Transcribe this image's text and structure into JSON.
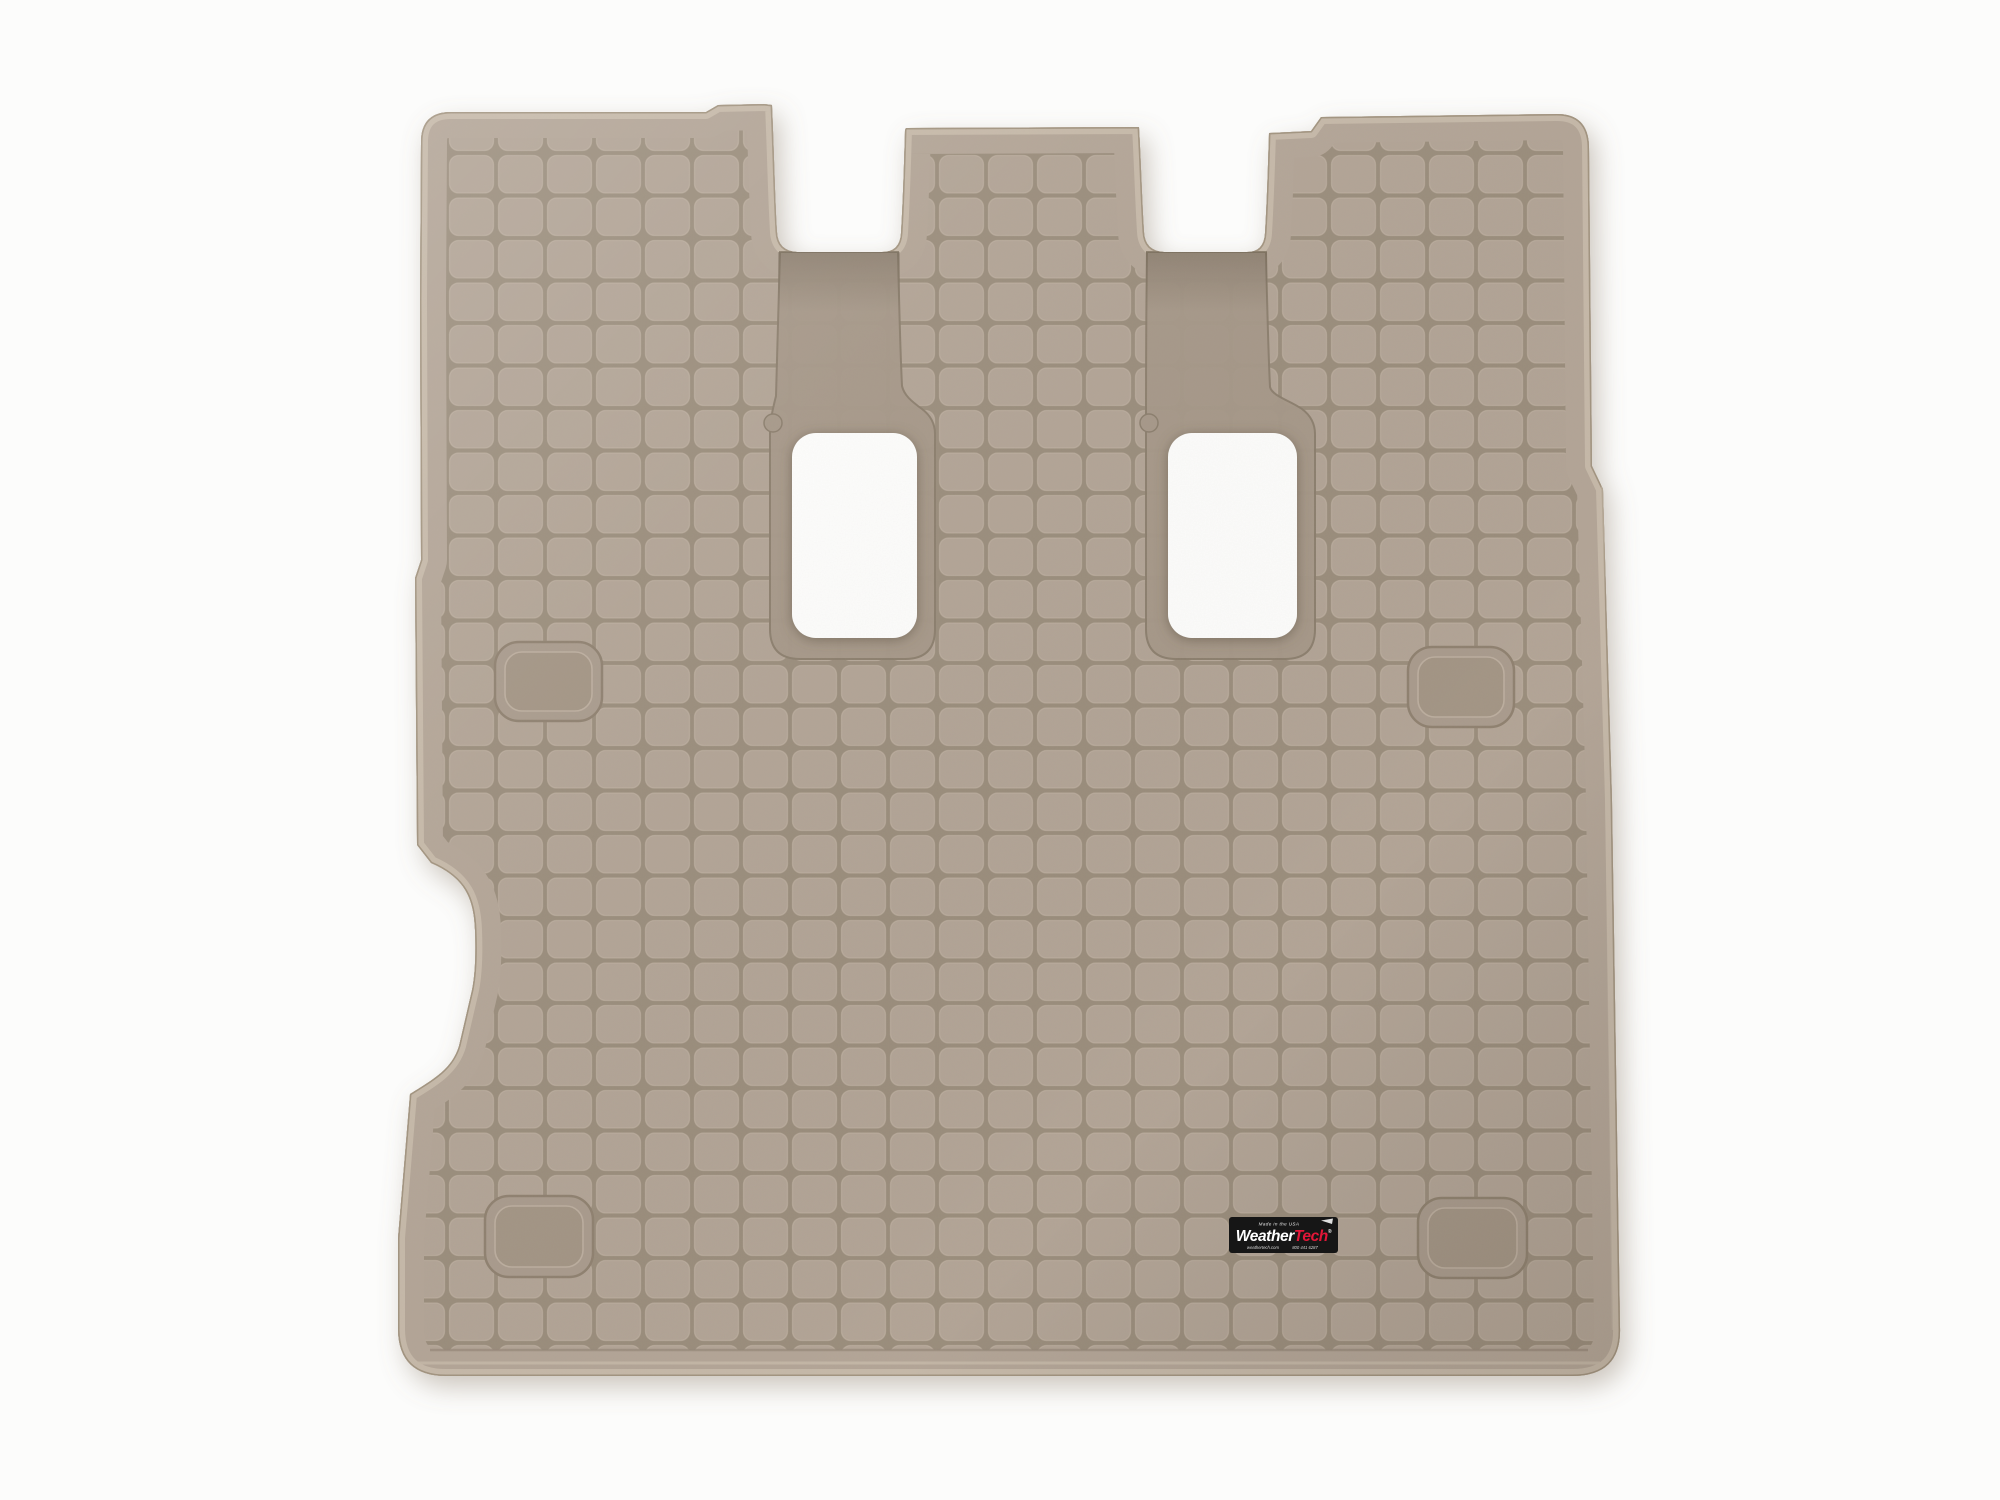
{
  "page": {
    "background": "#fcfcfb",
    "title": "Product photo of a tan WeatherTech vehicle cargo liner on a white background"
  },
  "product": {
    "name": "WeatherTech Cargo Liner",
    "color_name": "Tan",
    "features": [
      "square tread grid surface",
      "two rectangular seat-anchor pass-through holes with recessed channels",
      "two top seat-back notches",
      "four recessed tie-down pads",
      "left-edge wheel-well indent",
      "WeatherTech badge at lower right"
    ]
  },
  "colors": {
    "mat_tile": "#b2a496",
    "mat_groove": "#9a8d7c",
    "mat_rim": "#b3a597",
    "rim_highlight": "#c9bcac",
    "edge_line": "#93856f",
    "recess": "#a69889",
    "hole_fill": "#fdfdfc",
    "drop_shadow": "#8a7c68",
    "label_bg": "#141414",
    "label_red": "#e31837"
  },
  "label": {
    "made_in": "Made in the USA",
    "brand_white": "Weather",
    "brand_red": "Tech",
    "registered": "®",
    "website": "weathertech.com",
    "phone": "800 441 6287"
  }
}
